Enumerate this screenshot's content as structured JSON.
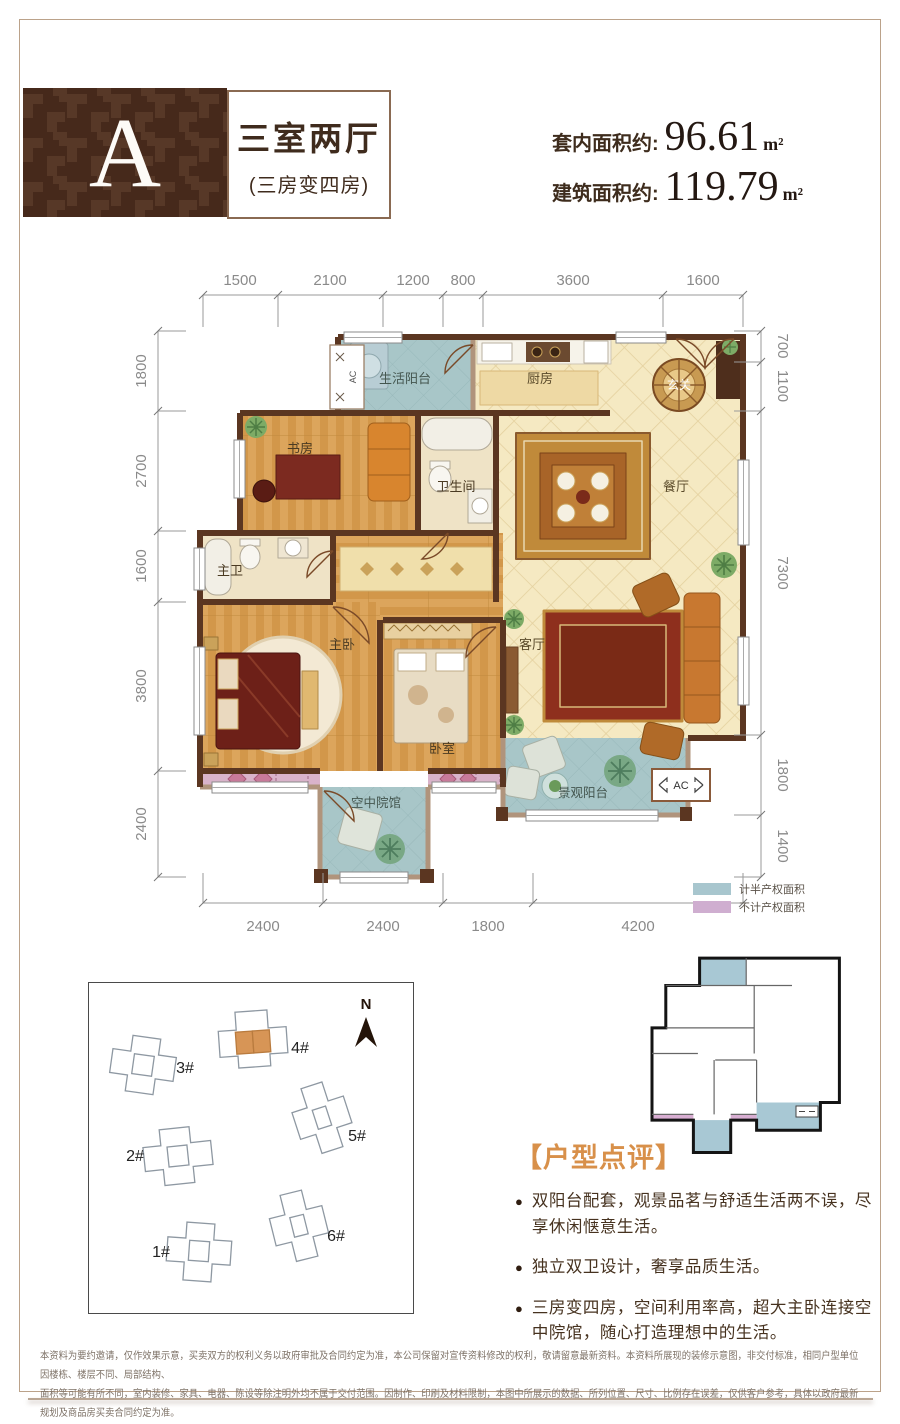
{
  "header": {
    "unit_letter": "A",
    "title": "三室两厅",
    "subtitle": "(三房变四房)",
    "areas": [
      {
        "label": "套内面积约:",
        "value": "96.61",
        "unit": "m²"
      },
      {
        "label": "建筑面积约:",
        "value": "119.79",
        "unit": "m²"
      }
    ]
  },
  "floorplan": {
    "rooms": {
      "life_balcony": "生活阳台",
      "kitchen": "厨房",
      "entry": "玄关",
      "study": "书房",
      "bathroom": "卫生间",
      "dining": "餐厅",
      "master_bath": "主卫",
      "master_bedroom": "主卧",
      "bedroom": "卧室",
      "living": "客厅",
      "sky_courtyard": "空中院馆",
      "view_balcony": "景观阳台"
    },
    "ac_label": "AC",
    "dims": {
      "top": [
        "1500",
        "2100",
        "1200",
        "800",
        "3600",
        "1600"
      ],
      "bottom": [
        "2400",
        "2400",
        "1800",
        "4200"
      ],
      "left": [
        "1800",
        "2700",
        "1600",
        "3800",
        "2400"
      ],
      "right": [
        "700",
        "1100",
        "7300",
        "1800",
        "1400"
      ]
    }
  },
  "legend": {
    "items": [
      {
        "label": "计半产权面积",
        "color": "#a8c6ce"
      },
      {
        "label": "不计产权面积",
        "color": "#cfaed0"
      }
    ]
  },
  "siteplan": {
    "north": "N",
    "buildings": [
      "1#",
      "2#",
      "3#",
      "4#",
      "5#",
      "6#"
    ]
  },
  "review": {
    "title": "【户型点评】",
    "bullets": [
      "双阳台配套，观景品茗与舒适生活两不误，尽享休闲惬意生活。",
      "独立双卫设计，奢享品质生活。",
      "三房变四房，空间利用率高，超大主卧连接空中院馆，随心打造理想中的生活。"
    ]
  },
  "disclaimer": {
    "line1": "本资料为要约邀请，仅作效果示意，买卖双方的权利义务以政府审批及合同约定为准，本公司保留对宣传资料修改的权利，敬请留意最新资料。本资料所展现的装修示意图，非交付标准，相同户型单位因楼栋、楼层不同、局部结构、",
    "line2": "面积等可能有所不同，室内装修、家具、电器、陈设等除注明外均不属于交付范围。因制作、印刷及材料限制，本图中所展示的数据、所列位置、尺寸、比例存在误差，仅供客户参考，具体以政府最新规划及商品房买卖合同约定为准。"
  },
  "colors": {
    "brand_brown": "#46291b",
    "wall_dark": "#5b3621",
    "accent_orange": "#d8904a",
    "blue_area": "#a8c6ce",
    "pink_area": "#cfaed0"
  }
}
